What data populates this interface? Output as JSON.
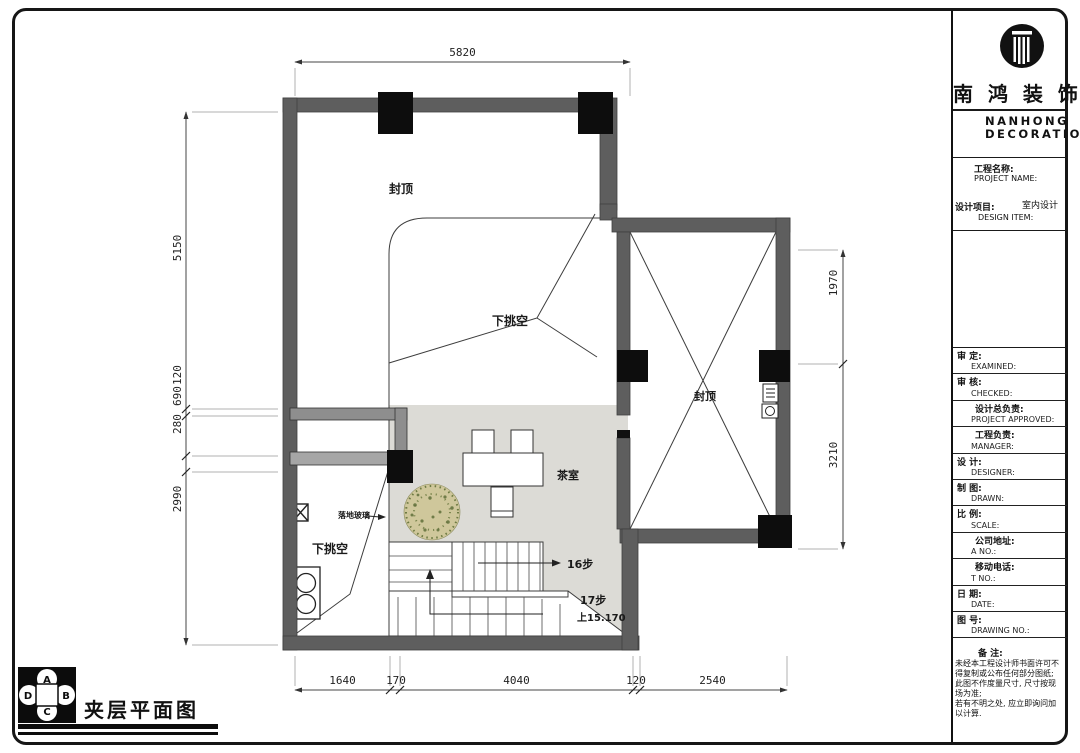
{
  "brand": {
    "logo": "pillar-logo",
    "cn": "南 鸿 装 饰",
    "en_line1": "NANHONG",
    "en_line2": "DECORATION"
  },
  "titleblock": {
    "project_label_cn": "工程名称:",
    "project_label_en": "PROJECT NAME:",
    "design_label_cn": "设计项目:",
    "design_label_en": "DESIGN ITEM:",
    "design_value": "室内设计",
    "rows": [
      {
        "cn": "审  定:",
        "en": "EXAMINED:"
      },
      {
        "cn": "审  核:",
        "en": "CHECKED:"
      },
      {
        "cn": "设计总负责:",
        "en": "PROJECT APPROVED:"
      },
      {
        "cn": "工程负责:",
        "en": "MANAGER:"
      },
      {
        "cn": "设  计:",
        "en": "DESIGNER:"
      },
      {
        "cn": "制  图:",
        "en": "DRAWN:"
      },
      {
        "cn": "比  例:",
        "en": "SCALE:"
      },
      {
        "cn": "公司地址:",
        "en": "A  NO.:"
      },
      {
        "cn": "移动电话:",
        "en": "T  NO.:"
      },
      {
        "cn": "日  期:",
        "en": "DATE:"
      },
      {
        "cn": "图  号:",
        "en": "DRAWING NO.:"
      }
    ],
    "notes_label": "备  注:",
    "notes": [
      "未经本工程设计师书面许可不",
      "得复制或公布任何部分图纸;",
      "此图不作度量尺寸, 尺寸按现",
      "场为准;",
      "若有不明之处, 应立即询问加",
      "以计算."
    ]
  },
  "plan": {
    "labels": {
      "capped_left": "封顶",
      "void_center": "下挑空",
      "void_bottom_left": "下挑空",
      "tea_room": "茶室",
      "floor_glass": "落地玻璃",
      "steps_16": "16步",
      "steps_17": "17步",
      "up_elevation": "上15.170",
      "capped_right": "封顶"
    },
    "dims": {
      "top": [
        "5820"
      ],
      "left": [
        "5150",
        "120",
        "690",
        "280",
        "2990"
      ],
      "right": [
        "1970",
        "3210"
      ],
      "bottom": [
        "1640",
        "170",
        "4040",
        "120",
        "2540"
      ]
    },
    "colors": {
      "wall": "#5e5e5e",
      "column": "#0d0d0d",
      "floor": "#dcdbd6",
      "line": "#3c3c3c"
    }
  },
  "footer": {
    "drawing_title": "夹层平面图",
    "compass": {
      "top": "A",
      "right": "B",
      "bottom": "C",
      "left": "D"
    }
  }
}
